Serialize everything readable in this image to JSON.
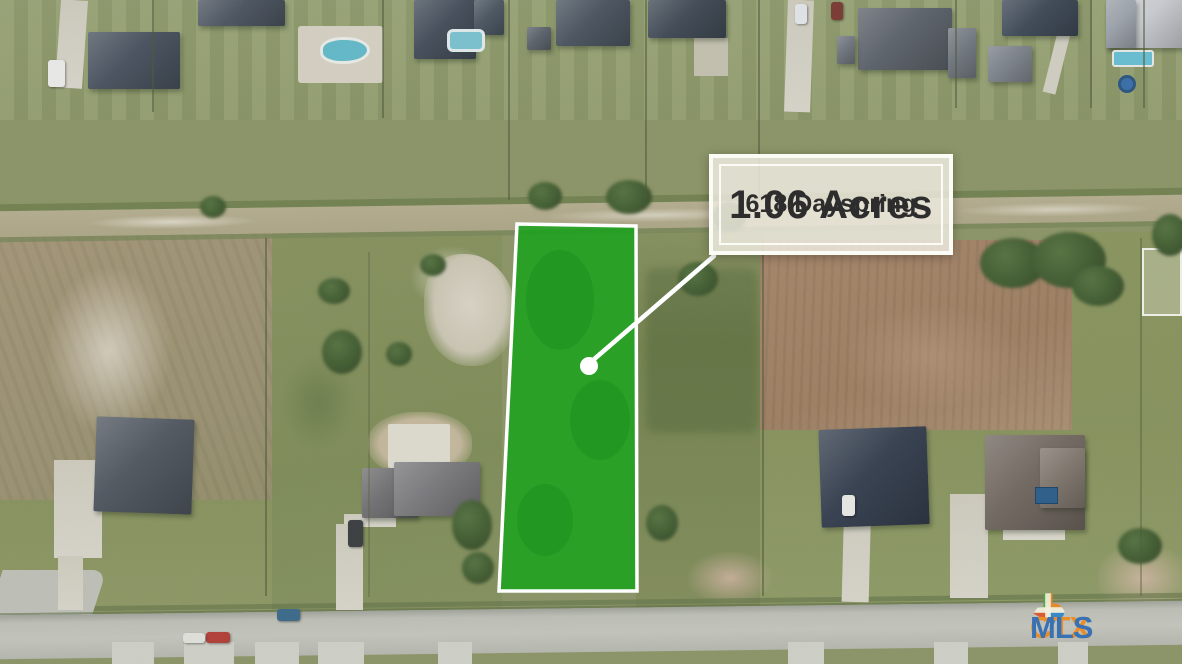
{
  "overlay": {
    "acreage": "1.06 Acres",
    "address": "618 Dayspring"
  },
  "watermark": {
    "ctx": "CTX",
    "mls": "MLS",
    "ctx_color": "#ef8b1e",
    "mls_color": "#2f6cb4"
  },
  "parcel_highlight": {
    "polygon": [
      [
        517,
        224
      ],
      [
        636,
        226
      ],
      [
        637,
        591
      ],
      [
        499,
        591
      ]
    ],
    "marker": [
      589,
      366
    ],
    "marker_radius": 9,
    "callout_line": [
      [
        592,
        361
      ],
      [
        714,
        256
      ]
    ],
    "fill_color": "#12a317",
    "stroke_color": "#ffffff"
  },
  "colors": {
    "label_background": "rgba(236,233,221,0.86)",
    "label_text": "#2d2d2d"
  }
}
